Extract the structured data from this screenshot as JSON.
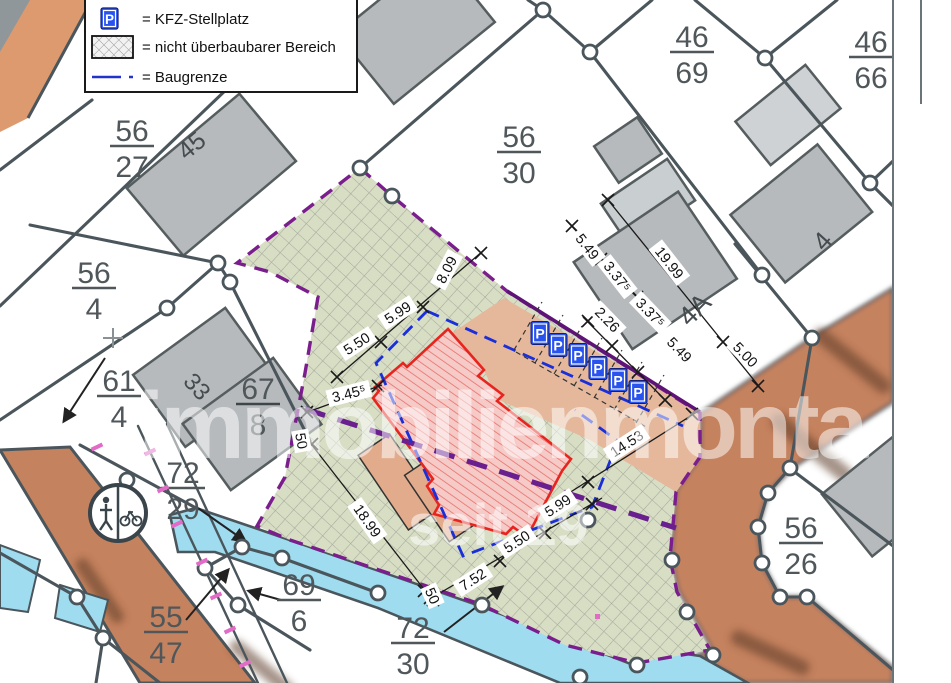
{
  "legend": {
    "items": [
      {
        "symbol": "P",
        "label": "= KFZ-Stellplatz"
      },
      {
        "symbol": "hatch",
        "label": "= nicht überbaubarer Bereich"
      },
      {
        "symbol": "dash",
        "label": "= Baugrenze"
      }
    ]
  },
  "parcels": [
    {
      "num": "56",
      "den": "27"
    },
    {
      "num": "56",
      "den": "4"
    },
    {
      "num": "61",
      "den": "4"
    },
    {
      "num": "67",
      "den": "8"
    },
    {
      "num": "56",
      "den": "30"
    },
    {
      "num": "46",
      "den": "69"
    },
    {
      "num": "46",
      "den": "66"
    },
    {
      "num": "72",
      "den": "29"
    },
    {
      "num": "55",
      "den": "47"
    },
    {
      "num": "69",
      "den": "6"
    },
    {
      "num": "72",
      "den": "30"
    },
    {
      "num": "56",
      "den": "26"
    }
  ],
  "buildings": {
    "b45": "45",
    "b33": "33",
    "b4a": "4A",
    "b4": "4"
  },
  "parking": {
    "symbol": "P",
    "spaces": 6
  },
  "dims": [
    "5.50",
    "5.99",
    "8.09",
    "3.45⁵",
    "5.49",
    "3.37⁵",
    "19.99",
    "2.26",
    "3.37⁵",
    "5.49",
    "5.00",
    "14.53",
    "18.99",
    "7.52",
    "5.50",
    "5.99",
    "50",
    "50"
  ],
  "watermark": {
    "line1": "immobilienmonta",
    "line2": "seit 19"
  },
  "colors": {
    "hatch_area": "#d8dec4",
    "boundary": "#4b565c",
    "baugrenze_blue": "#1a2fd8",
    "plot_boundary_purple": "#7a1d8d",
    "building_gray": "#b6babc",
    "planned_building_red": "#e8241f",
    "road_brown": "#c5825e",
    "water_cyan": "#9fdcef",
    "parking_tan": "#e5b89c",
    "parking_sign_blue": "#2853ef"
  }
}
